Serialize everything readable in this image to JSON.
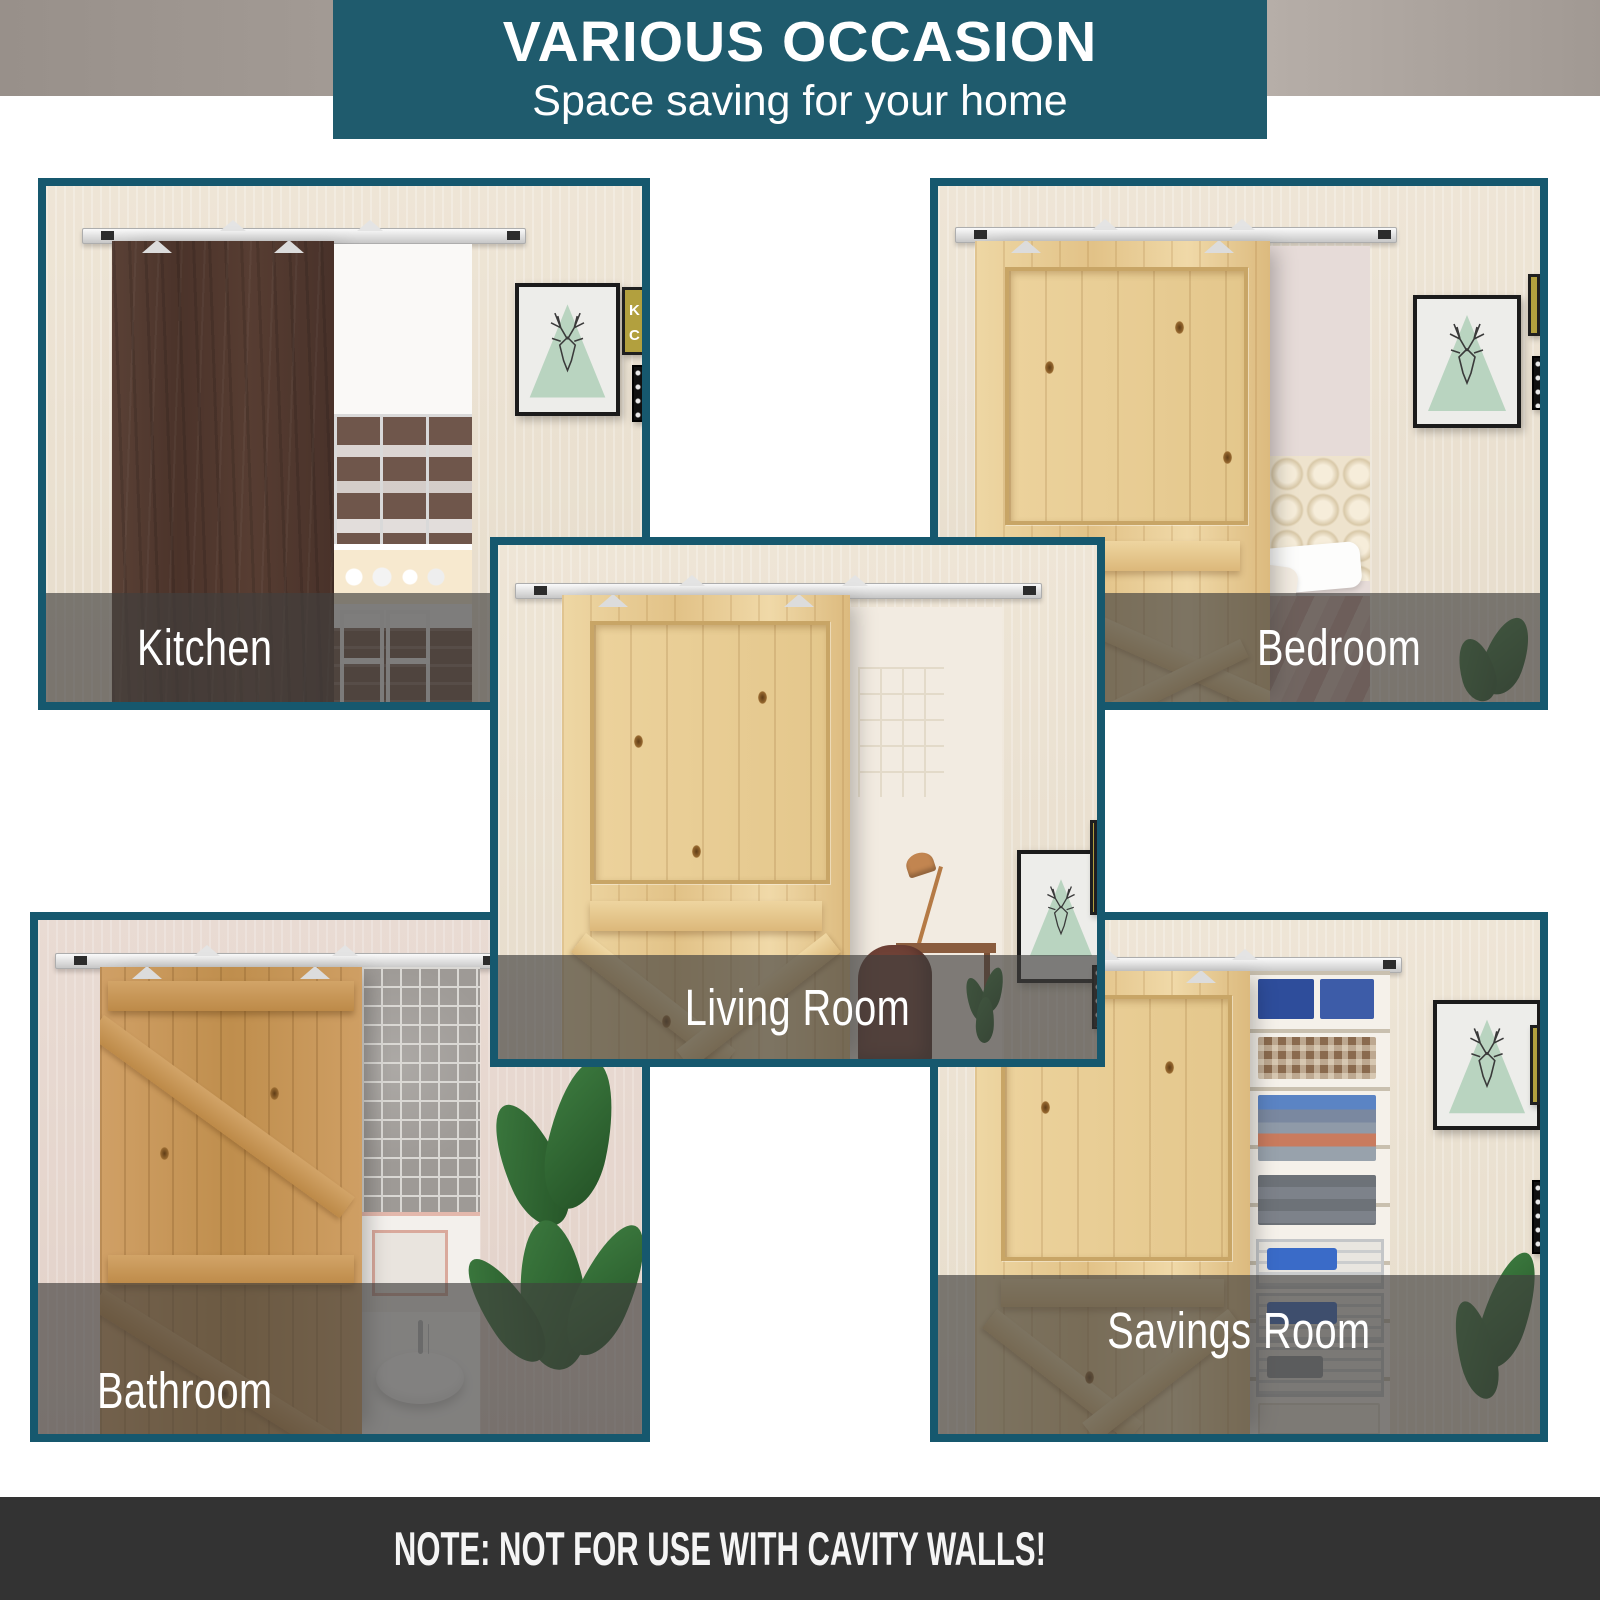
{
  "header": {
    "title": "VARIOUS OCCASION",
    "subtitle": "Space saving for your home"
  },
  "panels": [
    {
      "label": "Kitchen"
    },
    {
      "label": "Bedroom"
    },
    {
      "label": "Living Room"
    },
    {
      "label": "Bathroom"
    },
    {
      "label": "Savings Room"
    }
  ],
  "note": "NOTE: NOT FOR USE WITH CAVITY WALLS!",
  "poster": {
    "letters": [
      "K",
      "C",
      "CA"
    ]
  },
  "theme": {
    "banner_teal": "#1f5b6d",
    "panel_border_teal": "#16586e",
    "label_bar_gray": "rgba(66,64,62,0.66)",
    "note_bar_charcoal": "#333333",
    "art_green": "#b9d4c0",
    "wood_pine": "#e8c98e",
    "wood_oak": "#c79a63",
    "wood_walnut": "#523931"
  }
}
